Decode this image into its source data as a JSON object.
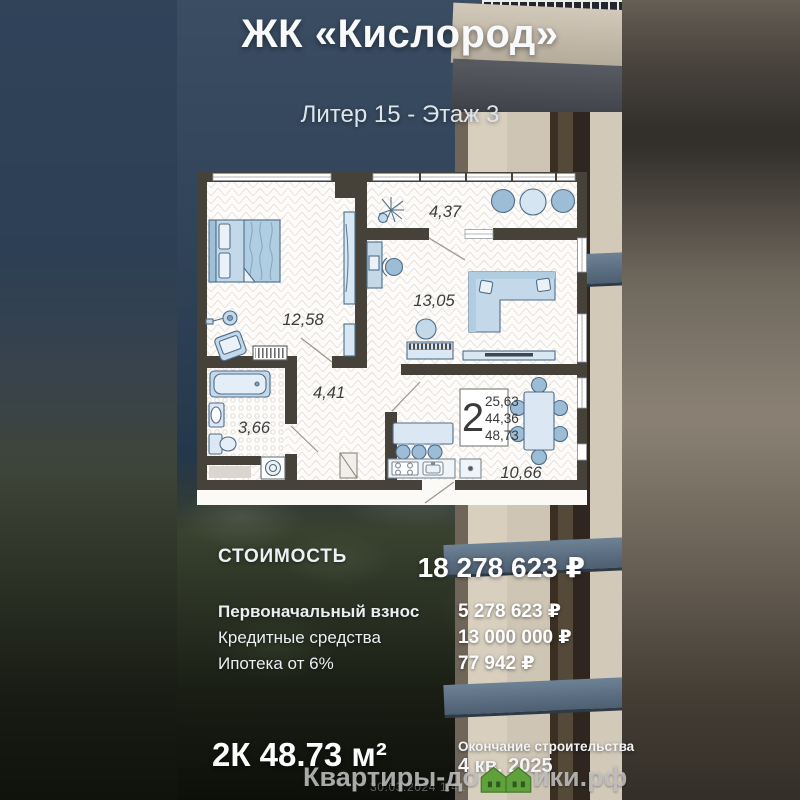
{
  "header": {
    "title": "ЖК «Кислород»",
    "subtitle": "Литер 15 - Этаж 3"
  },
  "floorplan": {
    "rooms": {
      "bedroom": "12,58",
      "balcony": "4,37",
      "living": "13,05",
      "hall": "4,41",
      "bath": "3,66",
      "kitchen": "10,66"
    },
    "stats": {
      "rooms_count": "2",
      "area_line1": "25,63",
      "area_line2": "44,36",
      "area_line3": "48,73"
    }
  },
  "pricing": {
    "title": "СТОИМОСТЬ",
    "total": "18 278 623 ₽",
    "rows": [
      {
        "label": "Первоначальный взнос",
        "value": "5 278 623 ₽"
      },
      {
        "label": "Кредитные средства",
        "value": "13 000 000 ₽"
      },
      {
        "label": "Ипотека от 6%",
        "value": "77 942 ₽"
      }
    ]
  },
  "footer": {
    "apartment": "2К 48.73 м²",
    "completion_label": "Окончание строительства",
    "completion_date": "4 кв. 2025"
  },
  "watermark": {
    "prefix": "Квартиры-до",
    "suffix": "ики.рф",
    "timestamp": "30.03.2024 1:41"
  },
  "colors": {
    "brand_green": "#5f9e3a",
    "furniture_blue": "#c3d9ea",
    "wall_dark": "#46423a",
    "balcony_band_blue": "#5b6f83"
  }
}
